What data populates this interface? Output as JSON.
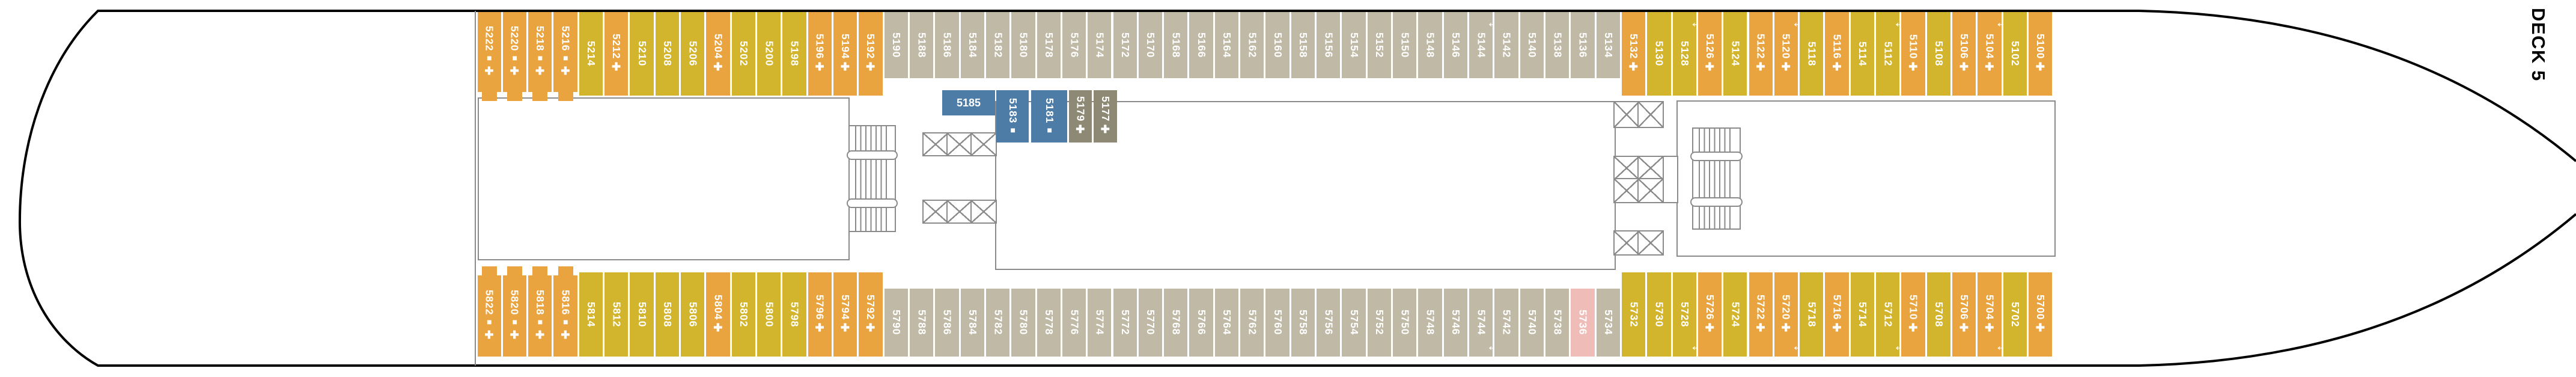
{
  "deck_label": "DECK 5",
  "colors": {
    "orange": "#E9A440",
    "yellow": "#D3B52D",
    "gray": "#BFB9A6",
    "taupe": "#8E8974",
    "blue": "#4D7CA6",
    "pink": "#EFBCB8",
    "wall": "#8a8a8a",
    "hull": "#000000",
    "cabin_text": "#ffffff"
  },
  "icon_glyphs": {
    "square": "■",
    "plus": "✚",
    "arrow": "↔"
  },
  "rows": {
    "top": {
      "cabins": [
        {
          "n": "5222",
          "c": "orange",
          "icons": [
            "square",
            "plus"
          ],
          "tab": true
        },
        {
          "n": "5220",
          "c": "orange",
          "icons": [
            "square",
            "plus"
          ],
          "tab": true
        },
        {
          "n": "5218",
          "c": "orange",
          "icons": [
            "square",
            "plus"
          ],
          "tab": true
        },
        {
          "n": "5216",
          "c": "orange",
          "icons": [
            "square",
            "plus"
          ],
          "tab": true
        },
        {
          "n": "5214",
          "c": "yellow",
          "icons": []
        },
        {
          "n": "5212",
          "c": "orange",
          "icons": [
            "plus"
          ]
        },
        {
          "n": "5210",
          "c": "yellow",
          "icons": []
        },
        {
          "n": "5208",
          "c": "yellow",
          "icons": []
        },
        {
          "n": "5206",
          "c": "yellow",
          "icons": []
        },
        {
          "n": "5204",
          "c": "orange",
          "icons": [
            "plus"
          ]
        },
        {
          "n": "5202",
          "c": "yellow",
          "icons": []
        },
        {
          "n": "5200",
          "c": "yellow",
          "icons": []
        },
        {
          "n": "5198",
          "c": "yellow",
          "icons": []
        },
        {
          "n": "5196",
          "c": "orange",
          "icons": [
            "plus"
          ]
        },
        {
          "n": "5194",
          "c": "orange",
          "icons": [
            "plus"
          ]
        },
        {
          "n": "5192",
          "c": "orange",
          "icons": [
            "plus"
          ]
        },
        {
          "n": "5190",
          "c": "gray",
          "icons": []
        },
        {
          "n": "5188",
          "c": "gray",
          "icons": []
        },
        {
          "n": "5186",
          "c": "gray",
          "icons": []
        },
        {
          "n": "5184",
          "c": "gray",
          "icons": []
        },
        {
          "n": "5182",
          "c": "gray",
          "icons": []
        },
        {
          "n": "5180",
          "c": "gray",
          "icons": []
        },
        {
          "n": "5178",
          "c": "gray",
          "icons": []
        },
        {
          "n": "5176",
          "c": "gray",
          "icons": []
        },
        {
          "n": "5174",
          "c": "gray",
          "icons": []
        },
        {
          "n": "5172",
          "c": "gray",
          "icons": []
        },
        {
          "n": "5170",
          "c": "gray",
          "icons": []
        },
        {
          "n": "5168",
          "c": "gray",
          "icons": []
        },
        {
          "n": "5166",
          "c": "gray",
          "icons": []
        },
        {
          "n": "5164",
          "c": "gray",
          "icons": []
        },
        {
          "n": "5162",
          "c": "gray",
          "icons": []
        },
        {
          "n": "5160",
          "c": "gray",
          "icons": []
        },
        {
          "n": "5158",
          "c": "gray",
          "icons": []
        },
        {
          "n": "5156",
          "c": "gray",
          "icons": []
        },
        {
          "n": "5154",
          "c": "gray",
          "icons": []
        },
        {
          "n": "5152",
          "c": "gray",
          "icons": []
        },
        {
          "n": "5150",
          "c": "gray",
          "icons": []
        },
        {
          "n": "5148",
          "c": "gray",
          "icons": []
        },
        {
          "n": "5146",
          "c": "gray",
          "icons": []
        },
        {
          "n": "5144",
          "c": "gray",
          "icons": [],
          "arrow": true
        },
        {
          "n": "5142",
          "c": "gray",
          "icons": []
        },
        {
          "n": "5140",
          "c": "gray",
          "icons": []
        },
        {
          "n": "5138",
          "c": "gray",
          "icons": []
        },
        {
          "n": "5136",
          "c": "gray",
          "icons": []
        },
        {
          "n": "5134",
          "c": "gray",
          "icons": []
        },
        {
          "n": "5132",
          "c": "orange",
          "icons": [
            "plus"
          ]
        },
        {
          "n": "5130",
          "c": "yellow",
          "icons": []
        },
        {
          "n": "5128",
          "c": "yellow",
          "icons": [],
          "arrow": true
        },
        {
          "n": "5126",
          "c": "orange",
          "icons": [
            "plus"
          ]
        },
        {
          "n": "5124",
          "c": "yellow",
          "icons": []
        },
        {
          "n": "5122",
          "c": "orange",
          "icons": [
            "plus"
          ]
        },
        {
          "n": "5120",
          "c": "orange",
          "icons": [
            "plus"
          ],
          "arrow": true
        },
        {
          "n": "5118",
          "c": "yellow",
          "icons": []
        },
        {
          "n": "5116",
          "c": "orange",
          "icons": [
            "plus"
          ]
        },
        {
          "n": "5114",
          "c": "yellow",
          "icons": []
        },
        {
          "n": "5112",
          "c": "yellow",
          "icons": [],
          "arrow": true
        },
        {
          "n": "5110",
          "c": "orange",
          "icons": [
            "plus"
          ]
        },
        {
          "n": "5108",
          "c": "yellow",
          "icons": []
        },
        {
          "n": "5106",
          "c": "orange",
          "icons": [
            "plus"
          ]
        },
        {
          "n": "5104",
          "c": "orange",
          "icons": [
            "plus"
          ],
          "arrow": true
        },
        {
          "n": "5102",
          "c": "yellow",
          "icons": []
        },
        {
          "n": "5100",
          "c": "orange",
          "icons": [
            "plus"
          ]
        }
      ]
    },
    "bottom": {
      "cabins": [
        {
          "n": "5822",
          "c": "orange",
          "icons": [
            "square",
            "plus"
          ],
          "tab": true
        },
        {
          "n": "5820",
          "c": "orange",
          "icons": [
            "square",
            "plus"
          ],
          "tab": true
        },
        {
          "n": "5818",
          "c": "orange",
          "icons": [
            "square",
            "plus"
          ],
          "tab": true
        },
        {
          "n": "5816",
          "c": "orange",
          "icons": [
            "square",
            "plus"
          ],
          "tab": true
        },
        {
          "n": "5814",
          "c": "yellow",
          "icons": []
        },
        {
          "n": "5812",
          "c": "yellow",
          "icons": []
        },
        {
          "n": "5810",
          "c": "yellow",
          "icons": []
        },
        {
          "n": "5808",
          "c": "yellow",
          "icons": []
        },
        {
          "n": "5806",
          "c": "yellow",
          "icons": []
        },
        {
          "n": "5804",
          "c": "orange",
          "icons": [
            "plus"
          ]
        },
        {
          "n": "5802",
          "c": "yellow",
          "icons": []
        },
        {
          "n": "5800",
          "c": "yellow",
          "icons": []
        },
        {
          "n": "5798",
          "c": "yellow",
          "icons": []
        },
        {
          "n": "5796",
          "c": "orange",
          "icons": [
            "plus"
          ]
        },
        {
          "n": "5794",
          "c": "orange",
          "icons": [
            "plus"
          ]
        },
        {
          "n": "5792",
          "c": "orange",
          "icons": [
            "plus"
          ]
        },
        {
          "n": "5790",
          "c": "gray",
          "icons": []
        },
        {
          "n": "5788",
          "c": "gray",
          "icons": []
        },
        {
          "n": "5786",
          "c": "gray",
          "icons": []
        },
        {
          "n": "5784",
          "c": "gray",
          "icons": []
        },
        {
          "n": "5782",
          "c": "gray",
          "icons": []
        },
        {
          "n": "5780",
          "c": "gray",
          "icons": []
        },
        {
          "n": "5778",
          "c": "gray",
          "icons": []
        },
        {
          "n": "5776",
          "c": "gray",
          "icons": []
        },
        {
          "n": "5774",
          "c": "gray",
          "icons": []
        },
        {
          "n": "5772",
          "c": "gray",
          "icons": []
        },
        {
          "n": "5770",
          "c": "gray",
          "icons": []
        },
        {
          "n": "5768",
          "c": "gray",
          "icons": []
        },
        {
          "n": "5766",
          "c": "gray",
          "icons": []
        },
        {
          "n": "5764",
          "c": "gray",
          "icons": []
        },
        {
          "n": "5762",
          "c": "gray",
          "icons": []
        },
        {
          "n": "5760",
          "c": "gray",
          "icons": []
        },
        {
          "n": "5758",
          "c": "gray",
          "icons": []
        },
        {
          "n": "5756",
          "c": "gray",
          "icons": []
        },
        {
          "n": "5754",
          "c": "gray",
          "icons": []
        },
        {
          "n": "5752",
          "c": "gray",
          "icons": []
        },
        {
          "n": "5750",
          "c": "gray",
          "icons": []
        },
        {
          "n": "5748",
          "c": "gray",
          "icons": []
        },
        {
          "n": "5746",
          "c": "gray",
          "icons": []
        },
        {
          "n": "5744",
          "c": "gray",
          "icons": [],
          "arrow": true
        },
        {
          "n": "5742",
          "c": "gray",
          "icons": []
        },
        {
          "n": "5740",
          "c": "gray",
          "icons": []
        },
        {
          "n": "5738",
          "c": "gray",
          "icons": []
        },
        {
          "n": "5736",
          "c": "pink",
          "icons": []
        },
        {
          "n": "5734",
          "c": "gray",
          "icons": []
        },
        {
          "n": "5732",
          "c": "yellow",
          "icons": []
        },
        {
          "n": "5730",
          "c": "yellow",
          "icons": []
        },
        {
          "n": "5728",
          "c": "yellow",
          "icons": [],
          "arrow": true
        },
        {
          "n": "5726",
          "c": "orange",
          "icons": [
            "plus"
          ]
        },
        {
          "n": "5724",
          "c": "yellow",
          "icons": []
        },
        {
          "n": "5722",
          "c": "orange",
          "icons": [
            "plus"
          ]
        },
        {
          "n": "5720",
          "c": "orange",
          "icons": [
            "plus"
          ],
          "arrow": true
        },
        {
          "n": "5718",
          "c": "yellow",
          "icons": []
        },
        {
          "n": "5716",
          "c": "orange",
          "icons": [
            "plus"
          ]
        },
        {
          "n": "5714",
          "c": "yellow",
          "icons": []
        },
        {
          "n": "5712",
          "c": "yellow",
          "icons": [],
          "arrow": true
        },
        {
          "n": "5710",
          "c": "orange",
          "icons": [
            "plus"
          ]
        },
        {
          "n": "5708",
          "c": "yellow",
          "icons": []
        },
        {
          "n": "5706",
          "c": "orange",
          "icons": [
            "plus"
          ]
        },
        {
          "n": "5704",
          "c": "orange",
          "icons": [
            "plus"
          ],
          "arrow": true
        },
        {
          "n": "5702",
          "c": "yellow",
          "icons": []
        },
        {
          "n": "5700",
          "c": "orange",
          "icons": [
            "plus"
          ]
        }
      ]
    },
    "middle": {
      "cabins": [
        {
          "n": "5185",
          "c": "blue",
          "icons": [],
          "horizontal": true
        },
        {
          "n": "5183",
          "c": "blue",
          "icons": [
            "square"
          ]
        },
        {
          "n": "5181",
          "c": "blue",
          "icons": [
            "square"
          ]
        },
        {
          "n": "5179",
          "c": "taupe",
          "icons": [
            "plus"
          ]
        },
        {
          "n": "5177",
          "c": "taupe",
          "icons": [
            "plus"
          ]
        }
      ]
    }
  }
}
